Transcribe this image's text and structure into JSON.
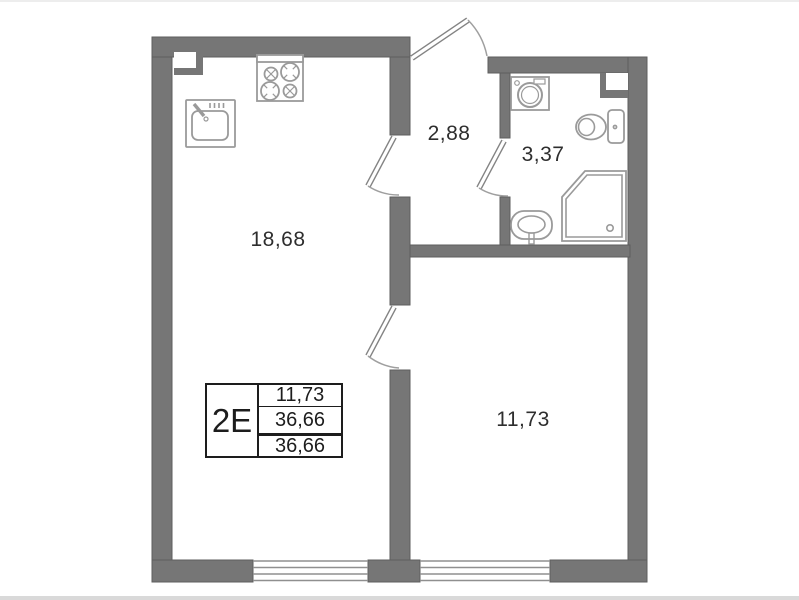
{
  "plan": {
    "unit_label": "2E",
    "rooms": [
      {
        "id": "kitchen-living-room",
        "area": "18,68"
      },
      {
        "id": "hallway",
        "area": "2,88"
      },
      {
        "id": "bathroom",
        "area": "3,37"
      },
      {
        "id": "bedroom",
        "area": "11,73"
      }
    ],
    "legend": {
      "unit": "2E",
      "rows": [
        "11,73",
        "36,66",
        "36,66"
      ]
    },
    "fixtures": [
      "kitchen-sink",
      "stove",
      "washing-machine",
      "toilet",
      "shower",
      "bathroom-sink"
    ],
    "colors": {
      "wall": "#767676",
      "fixture_line": "#9a9a9a",
      "text": "#2e2e2e"
    }
  }
}
